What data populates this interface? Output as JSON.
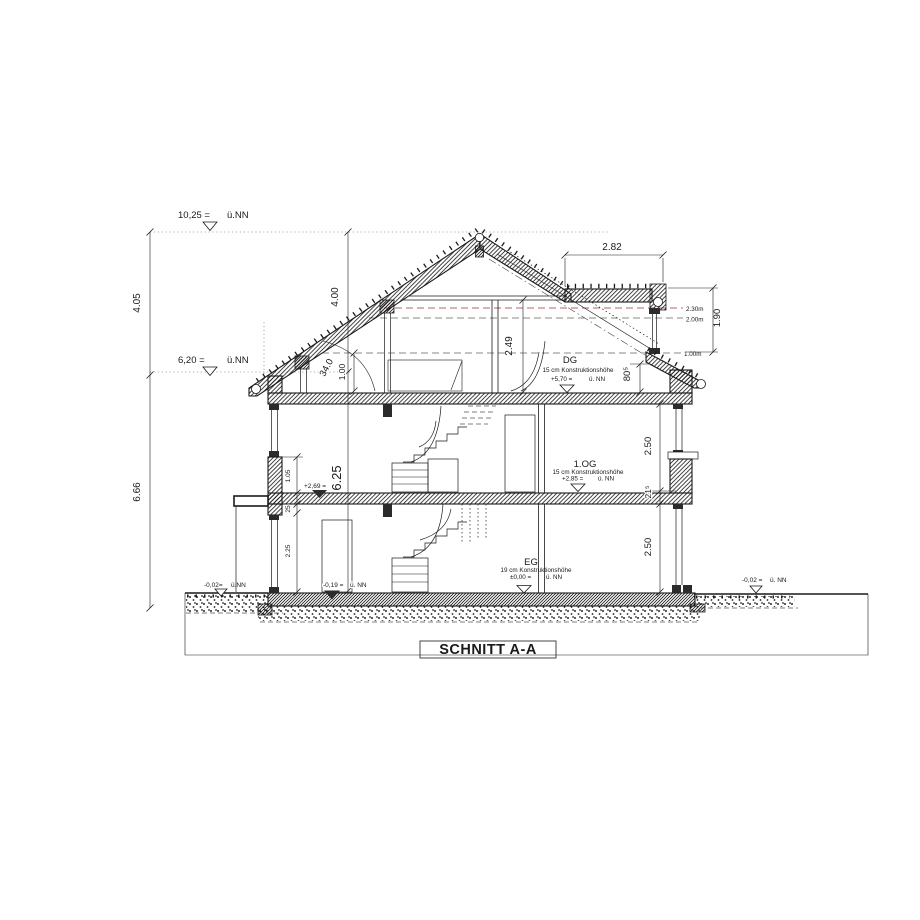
{
  "title": "SCHNITT A-A",
  "markers": {
    "ridge": {
      "value": "10,25 =",
      "datum": "ü.NN"
    },
    "eave": {
      "value": "6,20 =",
      "datum": "ü.NN"
    },
    "ground_left": {
      "value": "-0,02=",
      "datum": "ü.NN"
    },
    "ground_right": {
      "value": "-0,02 =",
      "datum": "ü. NN"
    },
    "entry": {
      "value": "-0,19 =",
      "datum": "ü. NN"
    },
    "canopy": {
      "value": "+2,69 ="
    }
  },
  "floors": {
    "dg": {
      "name": "DG",
      "construction": "15 cm Konstruktionshöhe",
      "level": "+5,70 =",
      "datum": "ü. NN"
    },
    "og": {
      "name": "1.OG",
      "construction": "15 cm Konstruktionshöhe",
      "level": "+2,85 =",
      "datum": "ü. NN"
    },
    "eg": {
      "name": "EG",
      "construction": "19 cm Konstruktionshöhe",
      "level": "±0,00 =",
      "datum": "ü. NN"
    }
  },
  "dimensions": {
    "roof_zone_height": "4.05",
    "body_height": "6.66",
    "upper_chain": "4.00",
    "shell_height": "6.25",
    "knee_height": "1.00",
    "terrace_width": "2.82",
    "terrace_height": "1.90",
    "dg_clear_height": "2.49",
    "drempel_height": "80⁵",
    "og_clear_height": "2.50",
    "slab_thickness": "21⁵",
    "eg_clear_height": "2.50",
    "parapet_height": "1.05",
    "lintel_depth": "25",
    "door_height": "2.25",
    "roof_pitch": "34.0"
  },
  "headroom_lines": {
    "h230": "2.30m",
    "h200": "2.00m",
    "h100": "1.00m"
  },
  "colors": {
    "line": "#1a1a1a",
    "headroom_red": "#b06363",
    "dashed_gray": "#8a8a8a"
  }
}
